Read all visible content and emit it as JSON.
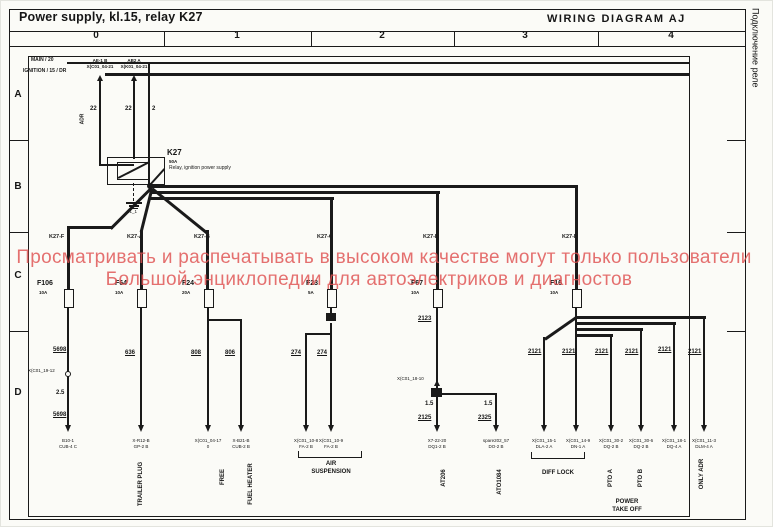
{
  "header": {
    "title": "Power supply, kl.15, relay K27",
    "diagram_title": "WIRING DIAGRAM  AJ",
    "side_note": "Подключение реле"
  },
  "grid": {
    "columns": [
      "0",
      "1",
      "2",
      "3",
      "4"
    ],
    "rows": [
      "A",
      "B",
      "C",
      "D"
    ]
  },
  "watermark": {
    "line1": "Просматривать и распечатывать в высоком качестве могут только пользователи",
    "line2": "Большой энциклопедии для автоэлектриков и диагностов",
    "color": "#e05252"
  },
  "relay": {
    "id": "K27",
    "rating": "50A",
    "description": "Relay, ignition power supply",
    "ground": "31_1"
  },
  "buses": {
    "main": "MAIN / 20",
    "ignition": "IGNITION / 15 / DR"
  },
  "texts": [
    [
      30,
      57,
      "s5b",
      "MAIN / 20",
      "bus-label-main"
    ],
    [
      22,
      68,
      "s5b",
      "IGNITION / 15 / DR",
      "bus-label-ignition"
    ],
    [
      99,
      58,
      "s45b ctr",
      "AE-1 B",
      "bus-tap-label"
    ],
    [
      99,
      64,
      "s45b ctr",
      "X(C01_04-21",
      "bus-tap-pin"
    ],
    [
      133,
      58,
      "s45b ctr",
      "AB2 A",
      "bus-tap-label"
    ],
    [
      133,
      64,
      "s45b ctr",
      "X(K01_04-21",
      "bus-tap-pin"
    ],
    [
      89,
      105,
      "s6b",
      "22",
      "wire-number"
    ],
    [
      124,
      105,
      "s6b",
      "22",
      "wire-number"
    ],
    [
      151,
      105,
      "s6b",
      "2",
      "wire-number"
    ],
    [
      82,
      118,
      "s5b rot",
      "ADR",
      "adr-note"
    ],
    [
      166,
      148,
      "s8b",
      "K27",
      "relay-id"
    ],
    [
      168,
      159,
      "s45b",
      "50A",
      "relay-rating"
    ],
    [
      168,
      165,
      "s5",
      "Relay, ignition power supply",
      "relay-description"
    ],
    [
      126,
      209,
      "s45",
      "31_1",
      "ground-label"
    ],
    [
      48,
      234,
      "s55b",
      "K27-F",
      "branch-label"
    ],
    [
      126,
      234,
      "s55b",
      "K27-A",
      "branch-label"
    ],
    [
      193,
      234,
      "s55b",
      "K27-B",
      "branch-label"
    ],
    [
      316,
      234,
      "s55b",
      "K27-C",
      "branch-label"
    ],
    [
      422,
      234,
      "s55b",
      "K27-D",
      "branch-label"
    ],
    [
      561,
      234,
      "s55b",
      "K27-E",
      "branch-label"
    ],
    [
      36,
      279,
      "s7b",
      "F106",
      "fuse-label"
    ],
    [
      38,
      290,
      "s45b",
      "10A",
      "fuse-rating"
    ],
    [
      114,
      279,
      "s7b",
      "F64",
      "fuse-label"
    ],
    [
      114,
      290,
      "s45b",
      "10A",
      "fuse-rating"
    ],
    [
      181,
      279,
      "s7b",
      "F24",
      "fuse-label"
    ],
    [
      181,
      290,
      "s45b",
      "20A",
      "fuse-rating"
    ],
    [
      305,
      279,
      "s7b",
      "F23",
      "fuse-label"
    ],
    [
      307,
      290,
      "s45b",
      "5A",
      "fuse-rating"
    ],
    [
      410,
      279,
      "s7b",
      "F67",
      "fuse-label"
    ],
    [
      410,
      290,
      "s45b",
      "10A",
      "fuse-rating"
    ],
    [
      549,
      279,
      "s7b",
      "F16",
      "fuse-label"
    ],
    [
      549,
      290,
      "s45b",
      "10A",
      "fuse-rating"
    ],
    [
      52,
      346,
      "s6bu",
      "5698",
      "wire-number"
    ],
    [
      124,
      349,
      "s6bu",
      "636",
      "wire-number"
    ],
    [
      190,
      349,
      "s6bu",
      "808",
      "wire-number"
    ],
    [
      224,
      349,
      "s6bu",
      "806",
      "wire-number"
    ],
    [
      290,
      349,
      "s6bu",
      "274",
      "wire-number"
    ],
    [
      316,
      349,
      "s6bu",
      "274",
      "wire-number"
    ],
    [
      417,
      315,
      "s6bu",
      "2123",
      "wire-number"
    ],
    [
      55,
      389,
      "s6b",
      "2.5",
      "wire-size"
    ],
    [
      52,
      411,
      "s6bu",
      "5698",
      "wire-number"
    ],
    [
      424,
      400,
      "s6b",
      "1.5",
      "wire-size"
    ],
    [
      483,
      400,
      "s6b",
      "1.5",
      "wire-size"
    ],
    [
      417,
      414,
      "s6bu",
      "2125",
      "wire-number"
    ],
    [
      477,
      414,
      "s6bu",
      "2325",
      "wire-number"
    ],
    [
      527,
      348,
      "s6bu",
      "2121",
      "wire-number"
    ],
    [
      561,
      348,
      "s6bu",
      "2121",
      "wire-number"
    ],
    [
      594,
      348,
      "s6bu",
      "2121",
      "wire-number"
    ],
    [
      624,
      348,
      "s6bu",
      "2121",
      "wire-number"
    ],
    [
      657,
      346,
      "s6bu",
      "2121",
      "wire-number"
    ],
    [
      687,
      348,
      "s6bu",
      "2121",
      "wire-number"
    ],
    [
      27,
      368,
      "s45",
      "X(C01_19-12",
      "connector-label"
    ],
    [
      396,
      376,
      "s45",
      "X(C01_18-10",
      "connector-label"
    ],
    [
      67,
      438,
      "s45 ctr",
      "B10-1",
      "connector-label"
    ],
    [
      67,
      444,
      "s45 ctr",
      "CUB-4 C",
      "connector-pin"
    ],
    [
      140,
      438,
      "s45 ctr",
      "X-R12-B",
      "connector-label"
    ],
    [
      140,
      444,
      "s45 ctr",
      "GP-2 B",
      "connector-pin"
    ],
    [
      207,
      438,
      "s45 ctr",
      "X(C01_04-17",
      "connector-label"
    ],
    [
      207,
      444,
      "s45 ctr",
      "0",
      "connector-pin"
    ],
    [
      240,
      438,
      "s45 ctr",
      "X-B21-B",
      "connector-label"
    ],
    [
      240,
      444,
      "s45 ctr",
      "CUB-2 B",
      "connector-pin"
    ],
    [
      305,
      438,
      "s45 ctr",
      "X(C01_10-8",
      "connector-label"
    ],
    [
      305,
      444,
      "s45 ctr",
      "FA-2 B",
      "connector-pin"
    ],
    [
      330,
      438,
      "s45 ctr",
      "X(C01_10-9",
      "connector-label"
    ],
    [
      330,
      444,
      "s45 ctr",
      "FA-2 B",
      "connector-pin"
    ],
    [
      436,
      438,
      "s45 ctr",
      "X7-22-20",
      "connector-label"
    ],
    [
      436,
      444,
      "s45 ctr",
      "DQ1-2 B",
      "connector-pin"
    ],
    [
      495,
      438,
      "s45 ctr",
      "spare202_57",
      "connector-label"
    ],
    [
      495,
      444,
      "s45 ctr",
      "DO-2 B",
      "connector-pin"
    ],
    [
      543,
      438,
      "s45 ctr",
      "X(C01_15-1",
      "connector-label"
    ],
    [
      543,
      444,
      "s45 ctr",
      "DLA-2 A",
      "connector-pin"
    ],
    [
      577,
      438,
      "s45 ctr",
      "X(C01_14-9",
      "connector-label"
    ],
    [
      577,
      444,
      "s45 ctr",
      "DN-1 A",
      "connector-pin"
    ],
    [
      610,
      438,
      "s45 ctr",
      "X(C01_30-2",
      "connector-label"
    ],
    [
      610,
      444,
      "s45 ctr",
      "DQ-2 B",
      "connector-pin"
    ],
    [
      640,
      438,
      "s45 ctr",
      "X(C01_30-6",
      "connector-label"
    ],
    [
      640,
      444,
      "s45 ctr",
      "DQ-2 B",
      "connector-pin"
    ],
    [
      673,
      438,
      "s45 ctr",
      "X(C01_18-1",
      "connector-label"
    ],
    [
      673,
      444,
      "s45 ctr",
      "DQ-4 A",
      "connector-pin"
    ],
    [
      703,
      438,
      "s45 ctr",
      "X(C01_11-3",
      "connector-label"
    ],
    [
      703,
      444,
      "s45 ctr",
      "DLM-4 A",
      "connector-pin"
    ],
    [
      140,
      483,
      "s6b rot",
      "TRAILER PLUG",
      "circuit-label-trailer-plug"
    ],
    [
      222,
      476,
      "s6b rot",
      "FREE",
      "circuit-label-free"
    ],
    [
      250,
      483,
      "s6b rot",
      "FUEL HEATER",
      "circuit-label-fuel-heater"
    ],
    [
      330,
      460,
      "s6b ctr",
      "AIR",
      "circuit-label-air-suspension"
    ],
    [
      330,
      468,
      "s6b ctr",
      "SUSPENSION",
      "circuit-label-air-suspension"
    ],
    [
      443,
      477,
      "s6b rot",
      "AT206",
      "circuit-label-at206"
    ],
    [
      499,
      481,
      "s6b rot",
      "ATO1084",
      "circuit-label-ato1084"
    ],
    [
      557,
      469,
      "s6b ctr",
      "DIFF LOCK",
      "circuit-label-diff-lock"
    ],
    [
      610,
      477,
      "s6b rot",
      "PTO A",
      "circuit-label-pto-a"
    ],
    [
      640,
      477,
      "s6b rot",
      "PTO B",
      "circuit-label-pto-b"
    ],
    [
      701,
      473,
      "s6b rot",
      "ONLY ADR",
      "circuit-label-only-adr"
    ],
    [
      626,
      498,
      "s6b ctr",
      "POWER",
      "circuit-label-power-take-off"
    ],
    [
      626,
      506,
      "s6b ctr",
      "TAKE OFF",
      "circuit-label-power-take-off"
    ]
  ],
  "lines": [
    [
      8,
      30,
      737,
      1
    ],
    [
      8,
      45,
      737,
      1
    ],
    [
      163,
      31,
      1,
      14
    ],
    [
      310,
      31,
      1,
      14
    ],
    [
      453,
      31,
      1,
      14
    ],
    [
      597,
      31,
      1,
      14
    ],
    [
      8,
      139,
      19,
      1
    ],
    [
      8,
      231,
      19,
      1
    ],
    [
      8,
      330,
      19,
      1
    ],
    [
      726,
      139,
      19,
      1
    ],
    [
      726,
      231,
      19,
      1
    ],
    [
      726,
      330,
      19,
      1
    ],
    [
      66,
      61,
      622,
      1.5
    ],
    [
      104,
      72,
      584,
      3
    ],
    [
      98,
      80,
      2,
      84
    ],
    [
      98,
      163,
      35,
      2
    ],
    [
      132,
      80,
      2,
      78
    ],
    [
      147,
      62,
      2,
      123
    ],
    [
      148,
      184,
      23,
      2,
      -48
    ],
    [
      149,
      184,
      428,
      3
    ],
    [
      574,
      184,
      3,
      104
    ],
    [
      149,
      190,
      290,
      3
    ],
    [
      435,
      190,
      3,
      98
    ],
    [
      149,
      196,
      184,
      3
    ],
    [
      329,
      196,
      3,
      92
    ],
    [
      150,
      186,
      57,
      3,
      135
    ],
    [
      66,
      225,
      46,
      3
    ],
    [
      66,
      225,
      3,
      63
    ],
    [
      151,
      186,
      45,
      3,
      104
    ],
    [
      139,
      229,
      3,
      59
    ],
    [
      151,
      186,
      71,
      3,
      39
    ],
    [
      205,
      229,
      3,
      59
    ],
    [
      117,
      176,
      34,
      1.5,
      -27
    ],
    [
      125,
      201,
      16,
      2
    ],
    [
      128,
      204,
      10,
      1.5
    ],
    [
      131,
      207,
      6,
      1
    ],
    [
      66,
      305,
      2,
      120
    ],
    [
      139,
      305,
      2,
      120
    ],
    [
      206,
      305,
      2,
      120
    ],
    [
      206,
      318,
      35,
      2
    ],
    [
      239,
      318,
      2,
      107
    ],
    [
      329,
      305,
      2,
      9
    ],
    [
      329,
      322,
      2,
      103
    ],
    [
      304,
      332,
      27,
      2
    ],
    [
      304,
      332,
      2,
      93
    ],
    [
      435,
      305,
      2,
      83
    ],
    [
      435,
      396,
      2,
      29
    ],
    [
      440,
      392,
      56,
      2
    ],
    [
      494,
      392,
      2,
      33
    ],
    [
      574,
      305,
      2,
      120
    ],
    [
      574,
      315,
      131,
      2.5
    ],
    [
      702,
      315,
      2,
      110
    ],
    [
      574,
      321,
      101,
      2.5
    ],
    [
      672,
      321,
      2,
      104
    ],
    [
      574,
      327,
      68,
      2.5
    ],
    [
      639,
      327,
      2,
      98
    ],
    [
      574,
      333,
      38,
      2.5
    ],
    [
      609,
      333,
      2,
      92
    ],
    [
      576,
      315,
      39,
      2.5,
      145
    ],
    [
      542,
      336,
      2,
      89
    ]
  ],
  "boxes": [
    {
      "k": "bx",
      "x": 8,
      "y": 8,
      "w": 735,
      "h": 509,
      "n": "outer-border"
    },
    {
      "k": "bx",
      "x": 27,
      "y": 55,
      "w": 660,
      "h": 459,
      "n": "inner-frame"
    },
    {
      "k": "bx",
      "x": 106,
      "y": 156,
      "w": 56,
      "h": 26,
      "n": "relay-body"
    },
    {
      "k": "bx",
      "x": 116,
      "y": 161,
      "w": 30,
      "h": 16,
      "n": "relay-coil"
    },
    {
      "k": "dash",
      "x": 132,
      "y": 182,
      "w": 1,
      "h": 18,
      "n": "relay-ground-lead"
    },
    {
      "k": "fill",
      "x": 325,
      "y": 312,
      "w": 10,
      "h": 8,
      "n": "splice"
    },
    {
      "k": "fill",
      "x": 430,
      "y": 387,
      "w": 11,
      "h": 9,
      "n": "splice"
    },
    {
      "k": "dotf",
      "x": 146,
      "y": 182,
      "w": 6,
      "h": 6,
      "n": "junction"
    },
    {
      "k": "fuse",
      "x": 63,
      "y": 288,
      "n": "fuse-F106"
    },
    {
      "k": "fuse",
      "x": 136,
      "y": 288,
      "n": "fuse-F64"
    },
    {
      "k": "fuse",
      "x": 203,
      "y": 288,
      "n": "fuse-F24"
    },
    {
      "k": "fuse",
      "x": 326,
      "y": 288,
      "n": "fuse-F23"
    },
    {
      "k": "fuse",
      "x": 432,
      "y": 288,
      "n": "fuse-F67"
    },
    {
      "k": "fuse",
      "x": 571,
      "y": 288,
      "n": "fuse-F16"
    },
    {
      "k": "dot",
      "x": 64,
      "y": 370,
      "n": "inline-connector"
    },
    {
      "k": "bracket",
      "x": 297,
      "y": 450,
      "w": 62,
      "h": 6,
      "n": "group-bracket"
    },
    {
      "k": "bracket",
      "x": 530,
      "y": 451,
      "w": 52,
      "h": 6,
      "n": "group-bracket"
    }
  ],
  "arrows": {
    "down_y": 424,
    "down_x": [
      67,
      140,
      207,
      240,
      305,
      330,
      436,
      495,
      543,
      575,
      610,
      640,
      673,
      703
    ],
    "up": [
      [
        99,
        74
      ],
      [
        133,
        74
      ],
      [
        436,
        379
      ]
    ]
  }
}
